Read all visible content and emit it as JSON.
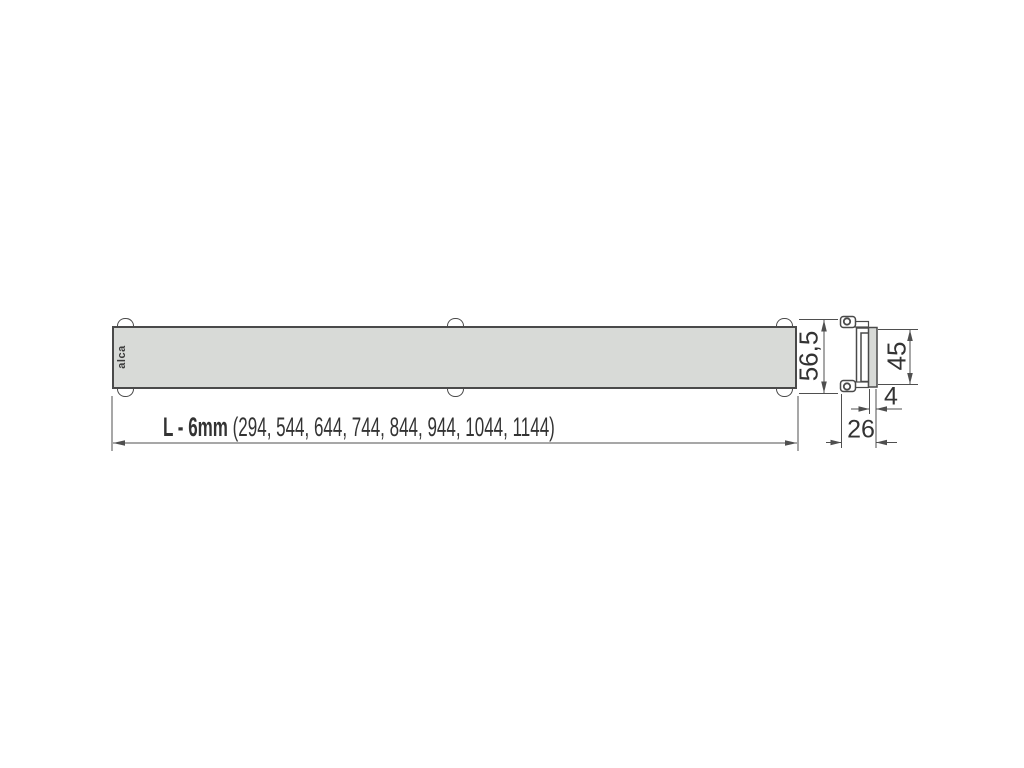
{
  "drawing": {
    "type": "technical-dimension-drawing",
    "brand_logo": "alca",
    "front_view": {
      "description": "long rectangular drain grate, front view",
      "length_dimension": {
        "label_bold": "L - 6mm",
        "label_values": "(294, 544, 644, 744, 844, 944, 1044, 1144)"
      },
      "width_dimension": "56,5"
    },
    "side_view": {
      "description": "cross-section of grate profile with mounting clips",
      "height_dimension": "45",
      "thickness_dimension": "4",
      "depth_dimension": "26"
    }
  },
  "colors": {
    "background": "#ffffff",
    "outline": "#4a4a4a",
    "dimension_line": "#4f4f4f",
    "grate_fill": "#d8dad7",
    "text": "#333333"
  }
}
